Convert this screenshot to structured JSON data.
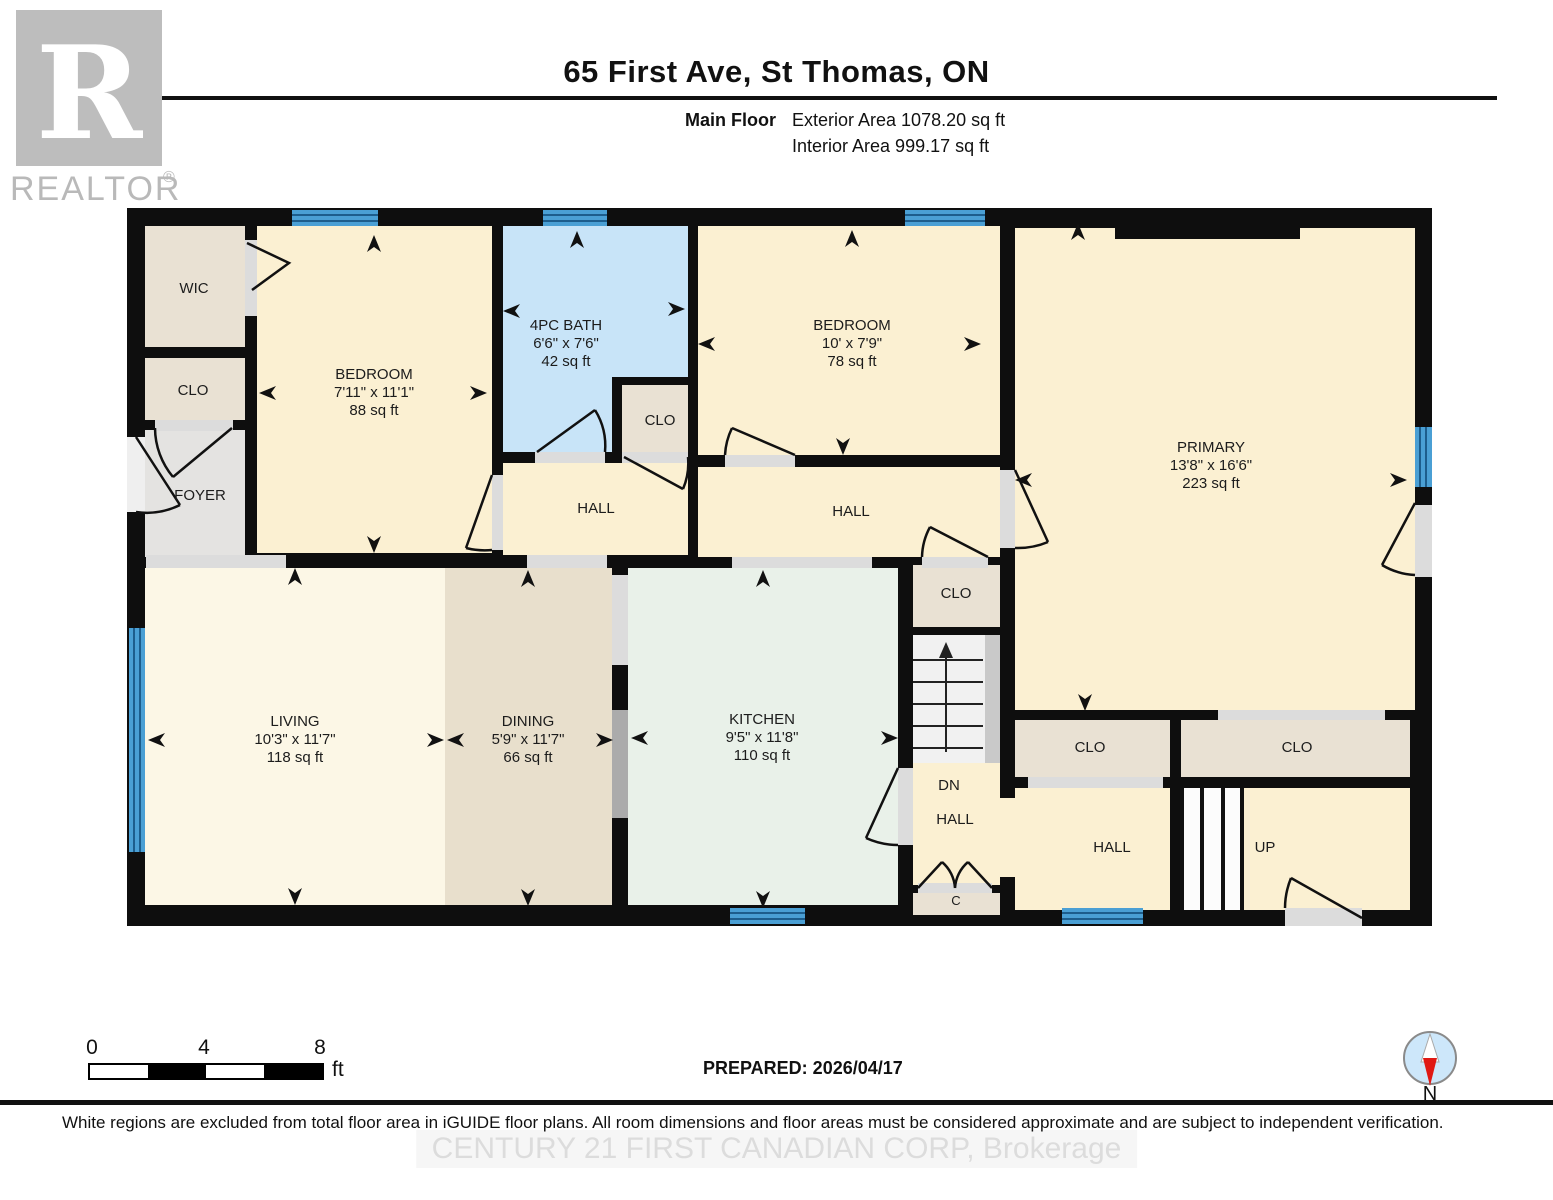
{
  "header": {
    "title": "65 First Ave, St Thomas, ON",
    "floor_label": "Main Floor",
    "exterior_area": "Exterior Area 1078.20 sq ft",
    "interior_area": "Interior Area 999.17 sq ft"
  },
  "logo": {
    "brand": "REALTOR",
    "registered": "®",
    "monogram": "R"
  },
  "rooms": {
    "wic": {
      "name": "WIC"
    },
    "clo_foyer": {
      "name": "CLO"
    },
    "foyer": {
      "name": "FOYER"
    },
    "bedroom1": {
      "name": "BEDROOM",
      "dims": "7'11\" x 11'1\"",
      "area": "88 sq ft"
    },
    "bath": {
      "name": "4PC BATH",
      "dims": "6'6\" x 7'6\"",
      "area": "42 sq ft"
    },
    "clo_bath": {
      "name": "CLO"
    },
    "bedroom2": {
      "name": "BEDROOM",
      "dims": "10' x 7'9\"",
      "area": "78 sq ft"
    },
    "hall_west": {
      "name": "HALL"
    },
    "hall_east": {
      "name": "HALL"
    },
    "primary": {
      "name": "PRIMARY",
      "dims": "13'8\" x 16'6\"",
      "area": "223 sq ft"
    },
    "clo_stairs": {
      "name": "CLO"
    },
    "living": {
      "name": "LIVING",
      "dims": "10'3\" x 11'7\"",
      "area": "118 sq ft"
    },
    "dining": {
      "name": "DINING",
      "dims": "5'9\" x 11'7\"",
      "area": "66 sq ft"
    },
    "kitchen": {
      "name": "KITCHEN",
      "dims": "9'5\" x 11'8\"",
      "area": "110 sq ft"
    },
    "dn": {
      "name": "DN"
    },
    "hall_down": {
      "name": "HALL"
    },
    "c_closet": {
      "name": "C"
    },
    "clo_rear_left": {
      "name": "CLO"
    },
    "clo_rear_right": {
      "name": "CLO"
    },
    "hall_rear": {
      "name": "HALL"
    },
    "up": {
      "name": "UP"
    }
  },
  "scale_bar": {
    "ticks": [
      "0",
      "4",
      "8"
    ],
    "unit": "ft"
  },
  "prepared_label": "PREPARED: 2026/04/17",
  "compass": {
    "north_label": "N"
  },
  "footer": {
    "disclaimer": "White regions are excluded from total floor area in iGUIDE floor plans. All room dimensions and floor areas must be considered approximate and are subject to independent verification.",
    "watermark": "CENTURY 21 FIRST CANADIAN CORP, Brokerage"
  },
  "colors": {
    "wall": "#0e0e0e",
    "room_cream": "#fbf0d2",
    "room_cream_light": "#fcf7e6",
    "room_tan": "#e8dfcc",
    "room_beige": "#e9e1d3",
    "room_gray": "#e4e3e1",
    "room_bath_blue": "#c8e4f8",
    "room_kitchen_mint": "#e9f1e9",
    "window_blue": "#4a9fd4",
    "opening_gray": "#dcdcdc",
    "passthrough_gray": "#ababab",
    "compass_red": "#e01813",
    "watermark_gray": "#dcdcdc"
  }
}
